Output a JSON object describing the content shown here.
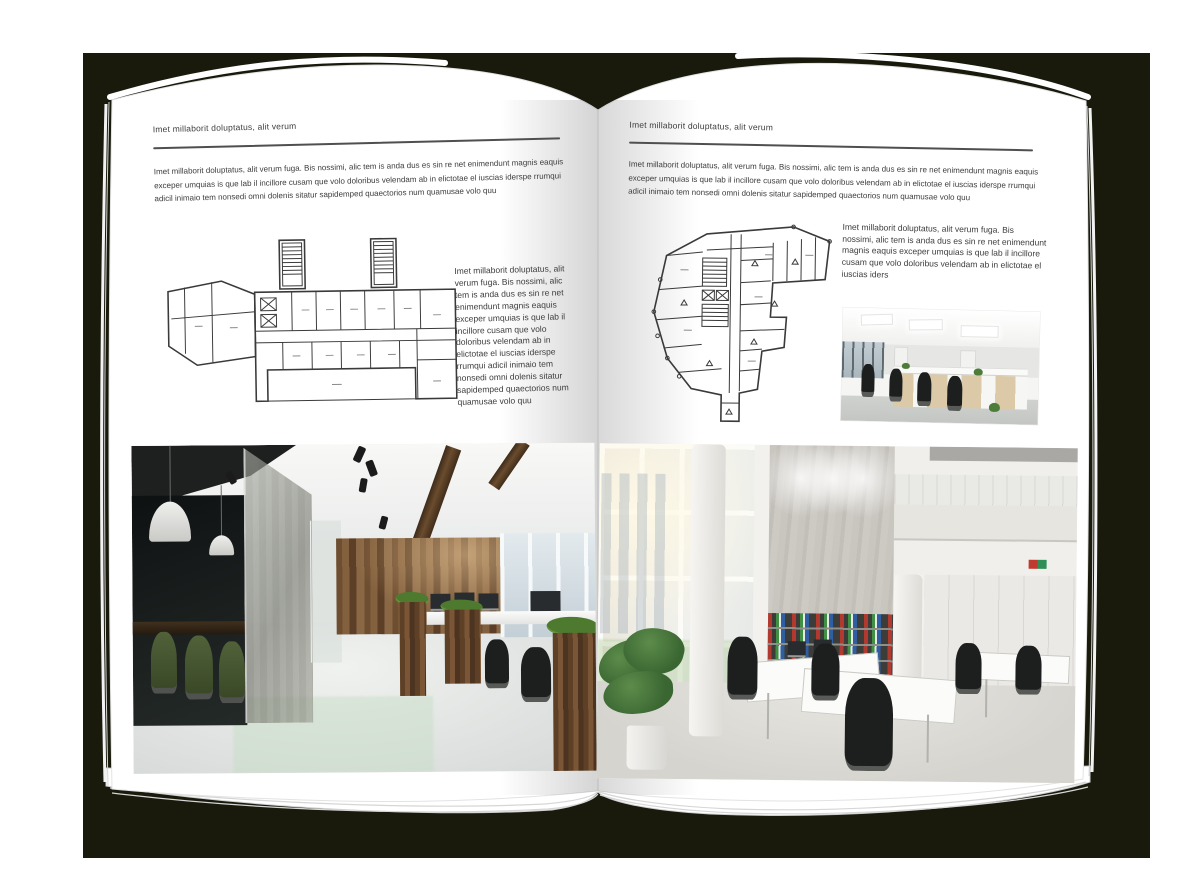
{
  "palette": {
    "backdrop": "#191a0c",
    "page": "#ffffff",
    "text": "#3c3c3c",
    "rule": "#4f4f4f",
    "plan_line": "#3a3a3a",
    "wood_dark": "#4a3522",
    "wood_mid": "#84613e",
    "glass_dark": "#15181a",
    "chair_green": "#46572e",
    "binder_red": "#b03a30",
    "binder_green": "#3f8f45",
    "binder_blue": "#2f5fa0"
  },
  "left_page": {
    "header": "Imet millaborit doluptatus, alit verum",
    "intro": "Imet millaborit doluptatus, alit verum fuga. Bis nossimi, alic tem is anda dus es sin re net enimendunt magnis eaquis exceper umquias is que lab il incillore cusam que volo doloribus velendam ab in elictotae el iuscias iderspe rrumqui adicil inimaio tem nonsedi omni dolenis sitatur sapidemped quaectorios num quamusae volo quu",
    "side_column": "Imet millaborit doluptatus, alit verum fuga. Bis nossimi, alic tem is anda dus es sin re net enimendunt magnis eaquis exceper umquias is que lab il incillore cusam que volo doloribus velendam ab in elictotae el iuscias iderspe rrumqui adicil inimaio tem nonsedi omni dolenis sitatur sapidemped quaectorios num quamusae volo quu"
  },
  "right_page": {
    "header": "Imet millaborit doluptatus, alit verum",
    "intro": "Imet millaborit doluptatus, alit verum fuga. Bis nossimi, alic tem is anda dus es sin re net enimendunt magnis eaquis exceper umquias is que lab il incillore cusam que volo doloribus velendam ab in elictotae el iuscias iderspe rrumqui adicil inimaio tem nonsedi omni dolenis sitatur sapidemped quaectorios num quamusae volo quu",
    "side_column": "Imet millaborit doluptatus, alit verum fuga. Bis nossimi, alic tem is anda dus es sin re net enimendunt magnis eaquis exceper umquias is que lab il incillore cusam que volo doloribus velendam ab in elictotae el iuscias iders"
  }
}
